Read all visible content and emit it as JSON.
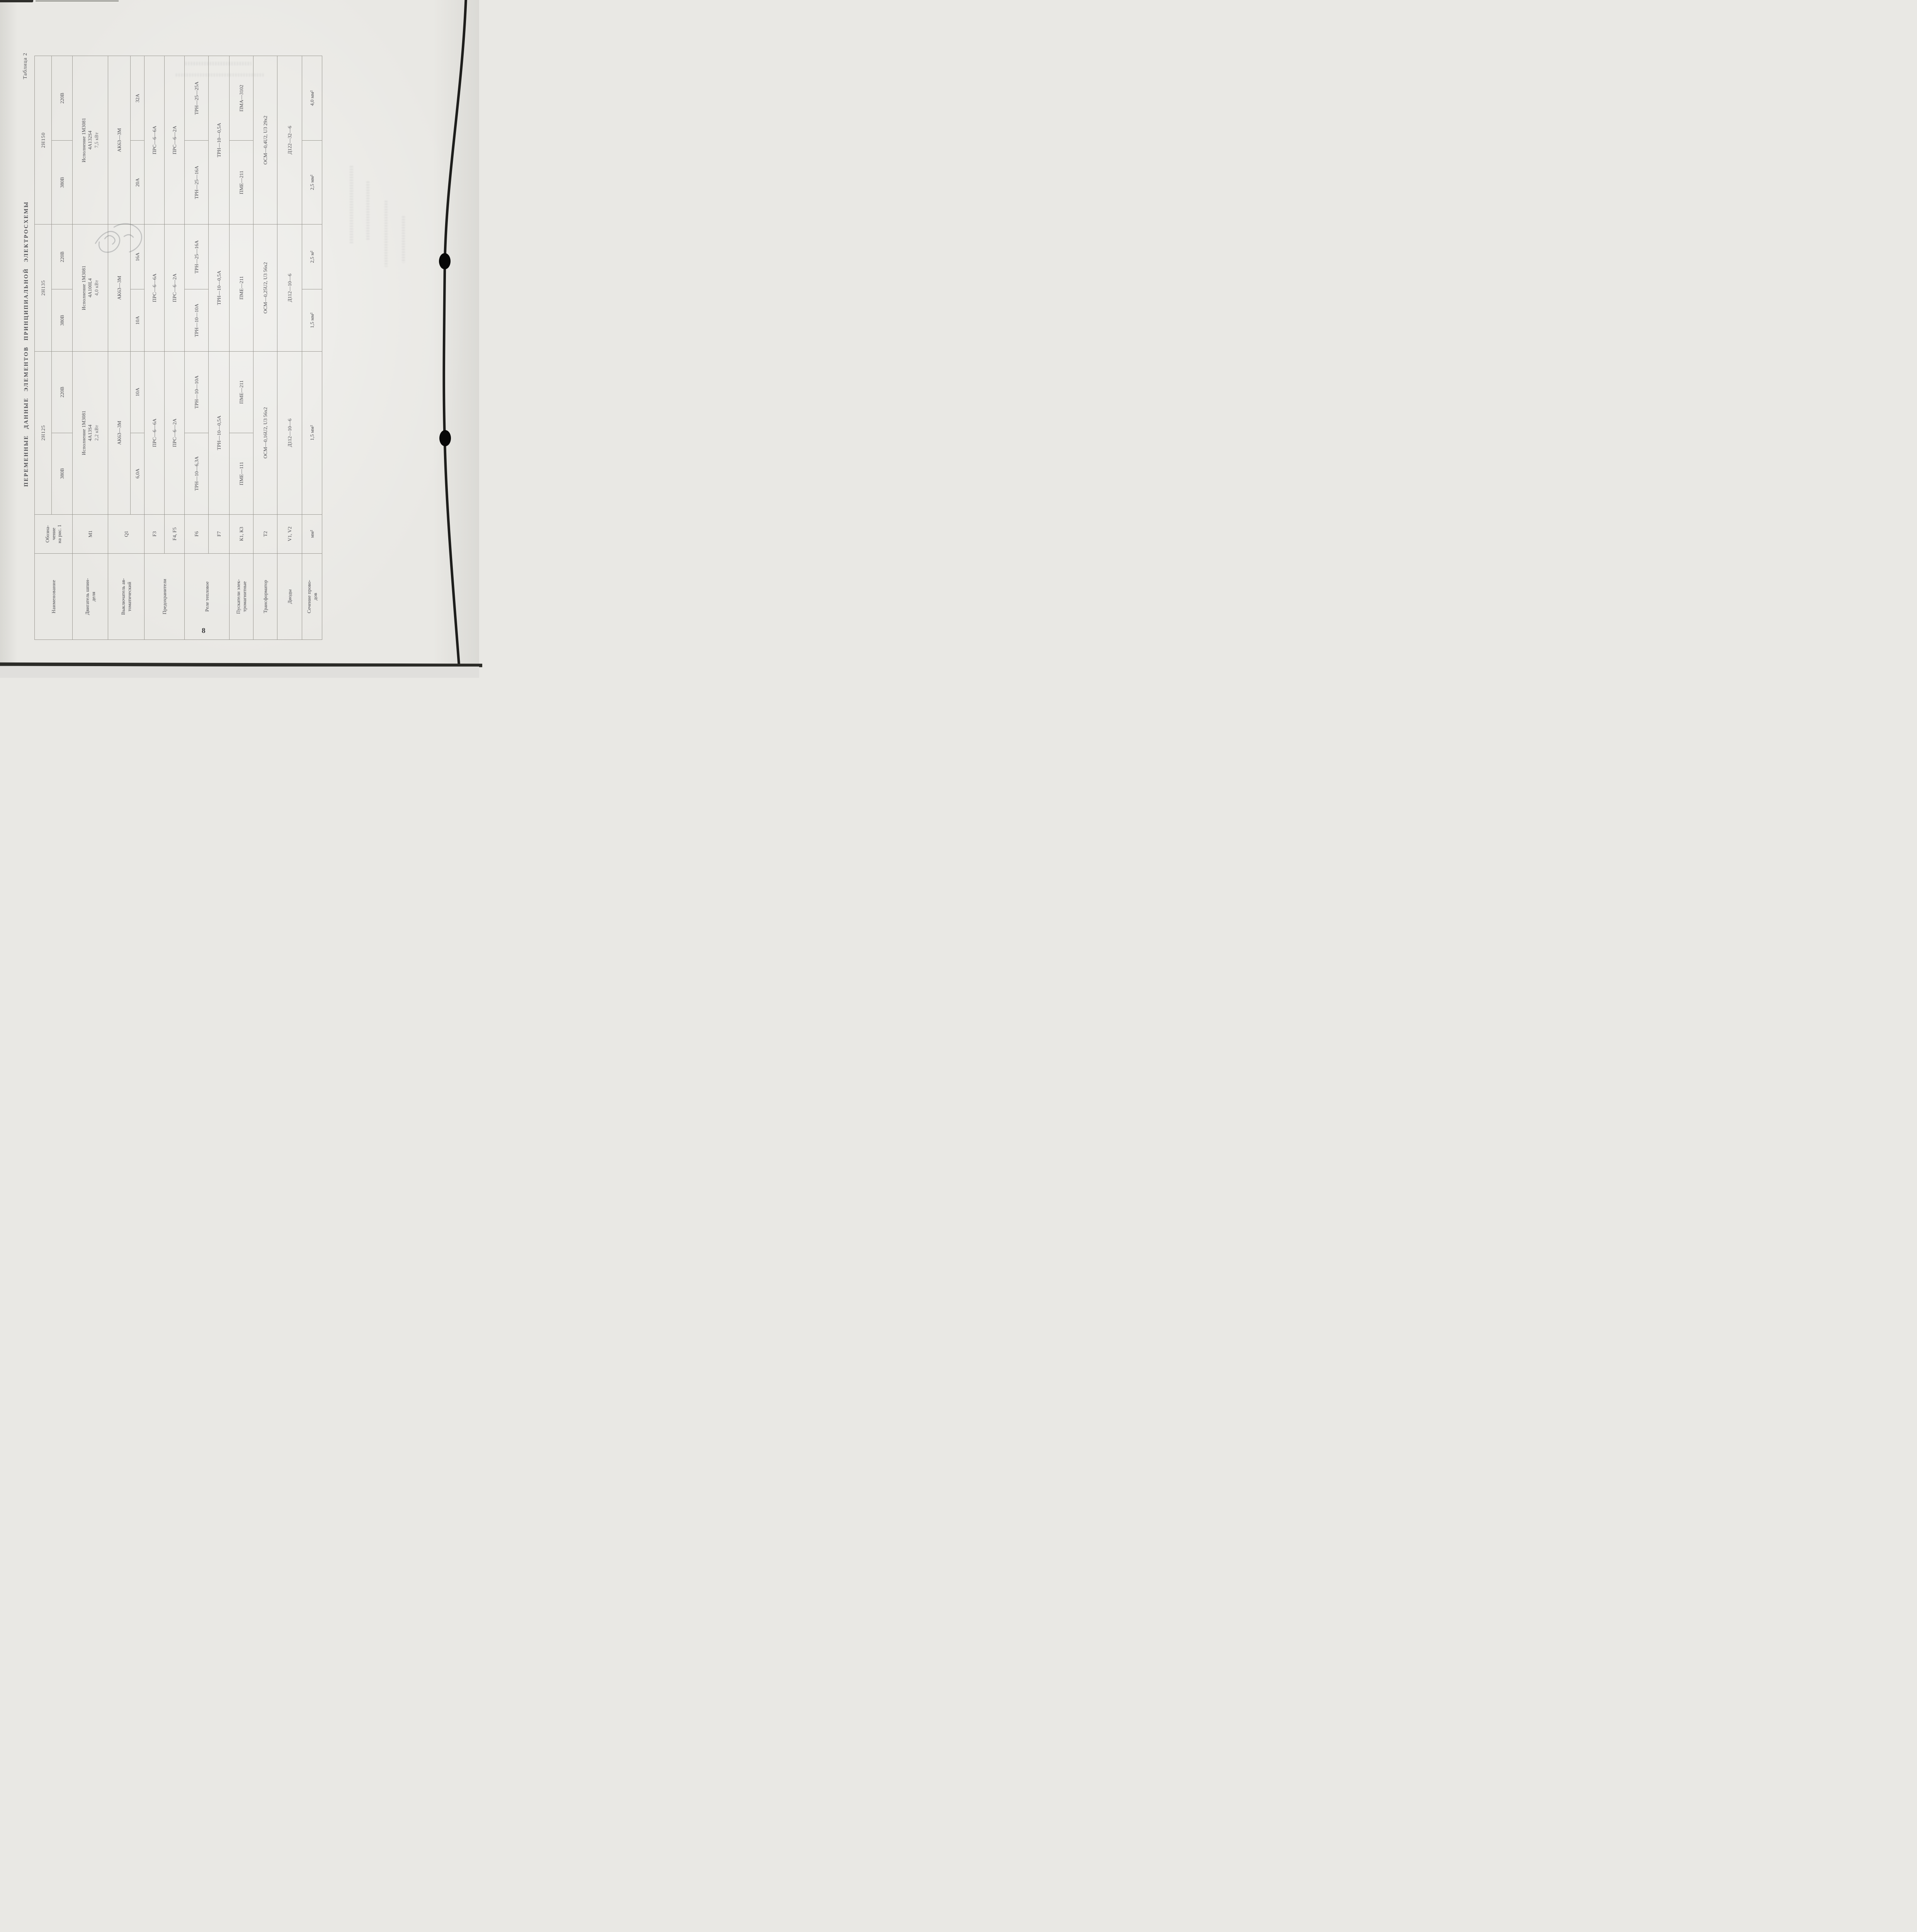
{
  "page": {
    "caption": "Таблица 2",
    "title": "ПЕРЕМЕННЫЕ ДАННЫЕ ЭЛЕМЕНТОВ ПРИНЦИПИАЛЬНОЙ ЭЛЕКТРОСХЕМЫ",
    "number": "8"
  },
  "table": {
    "headers": {
      "name": "Наименование",
      "designation": "Обозна-\nчение\nна рис. 1",
      "models": [
        "2Н125",
        "2Н135",
        "2Н150"
      ],
      "v380": "380В",
      "v220": "220В"
    },
    "rows": {
      "motor": {
        "name": "Двигатель шпин-\nделя",
        "desig": "М1",
        "v125": {
          "l1": "Исполнение 1М3081",
          "l2": "4А13S4",
          "l3": "2,2 кВт"
        },
        "v135": {
          "l1": "Исполнение 1М3081",
          "l2": "4А100L4",
          "l3": "4,0 кВт"
        },
        "v150": {
          "l1": "Исполнение 1М3081",
          "l2": "4А132S4",
          "l3": "7,5 кВт"
        }
      },
      "breaker": {
        "name": "Выключатель ав-\nтоматический",
        "desig": "Q1",
        "type": "АК63—3М",
        "amps": [
          "6,0А",
          "10А",
          "10А",
          "16А",
          "20А",
          "32А"
        ]
      },
      "fuses": {
        "name": "Предохранители",
        "f3": {
          "desig": "F3",
          "value": "ПРС—6—6А"
        },
        "f45": {
          "desig": "F4, F5",
          "value": "ПРС—6—2А"
        }
      },
      "relay": {
        "name": "Реле тепловое",
        "f6": {
          "desig": "F6",
          "values": [
            "ТРН—10—6,3А",
            "ТРН—10—10А",
            "ТРН—10—10А",
            "ТРН—25—16А",
            "ТРН—25—16А",
            "ТРН—25—25А"
          ]
        },
        "f7": {
          "desig": "F7",
          "value": "ТРН—10—0,5А"
        }
      },
      "starters": {
        "name": "Пускатели элек-\nтромагнитные",
        "desig": "К1, К3",
        "v125_380": "ПМЕ—111",
        "v125_220": "ПМЕ—211",
        "v135": "ПМЕ—211",
        "v150_380": "ПМЕ—211",
        "v150_220": "ПМА—3102"
      },
      "transformer": {
        "name": "Трансформатор",
        "desig": "Т2",
        "v125": "ОСМ—0,16U2, U3 56х2",
        "v135": "ОСМ—0,25U2, U3 56х2",
        "v150": "ОСМ—0,4U2, U3 29х2"
      },
      "diodes": {
        "name": "Диоды",
        "desig": "V1, V2",
        "v125": "Д112—10—6",
        "v135": "Д112—10—6",
        "v150": "Д122—32—6"
      },
      "wires": {
        "name": "Сечение прово-\nдов",
        "desig": "мм²",
        "v125": "1,5 мм²",
        "v135_380": "1,5 мм²",
        "v135_220": "2,5 м²",
        "v150_380": "2,5 мм²",
        "v150_220": "4,0 мм²"
      }
    }
  }
}
